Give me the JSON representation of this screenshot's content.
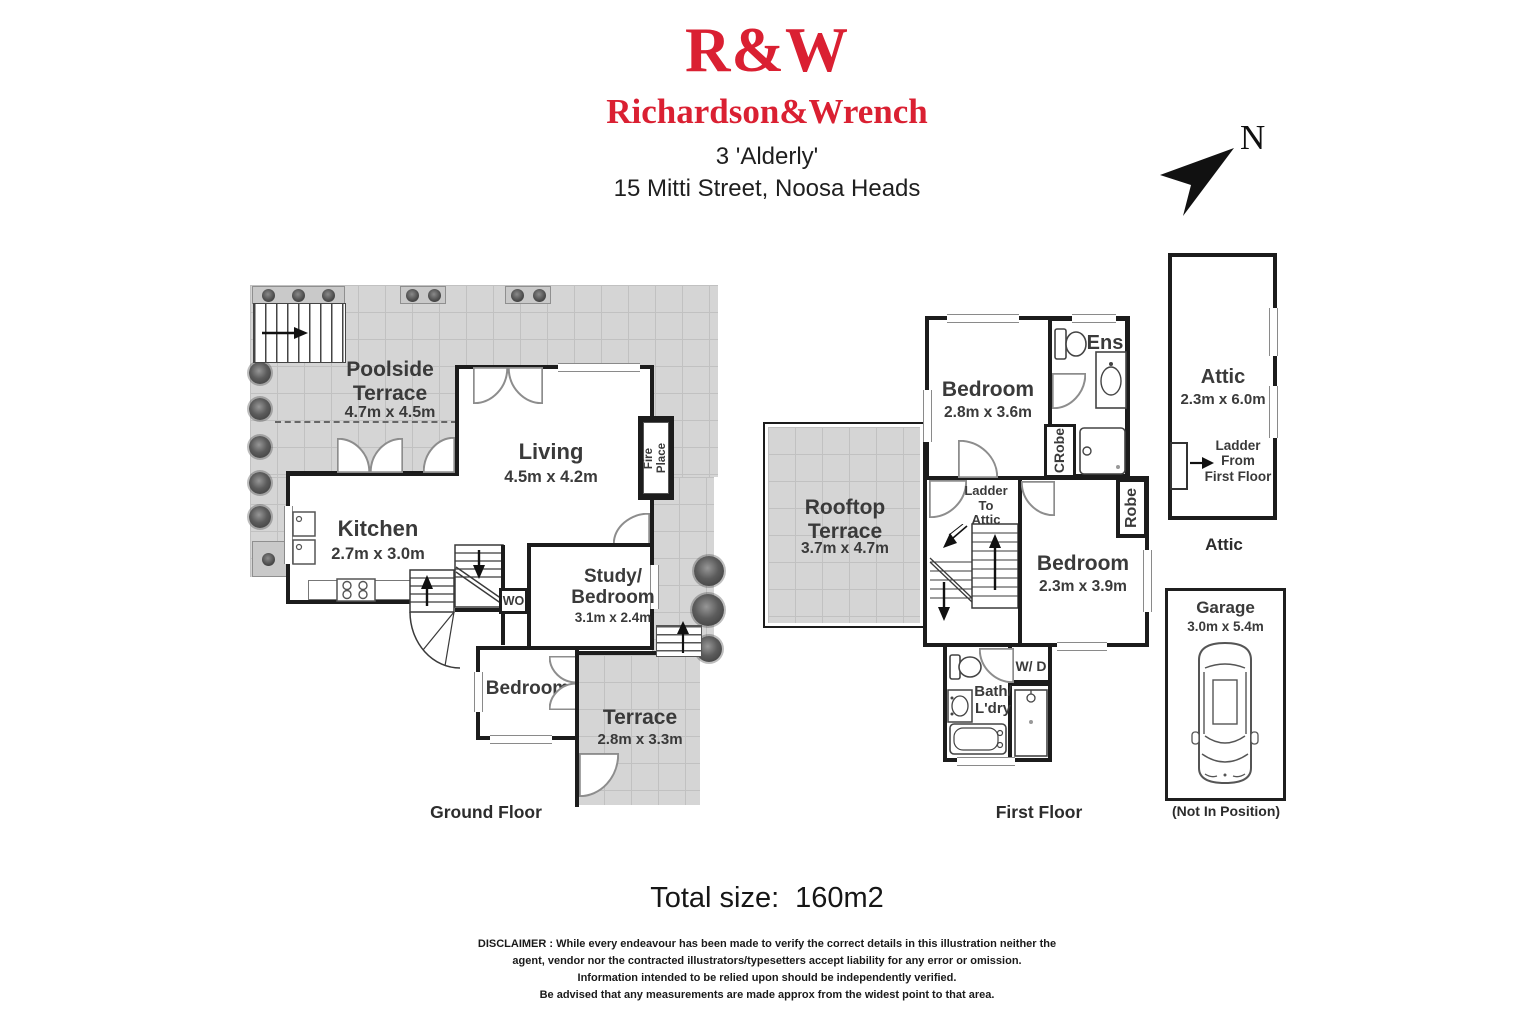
{
  "header": {
    "logo": "R&W",
    "brand": "Richardson&Wrench",
    "address_line1": "3 'Alderly'",
    "address_line2": "15 Mitti Street, Noosa Heads"
  },
  "compass": {
    "north_label": "N"
  },
  "ground_floor": {
    "floor_label": "Ground Floor",
    "poolside_terrace_name": "Poolside\nTerrace",
    "poolside_terrace_dims": "4.7m x 4.5m",
    "living_name": "Living",
    "living_dims": "4.5m x 4.2m",
    "kitchen_name": "Kitchen",
    "kitchen_dims": "2.7m x 3.0m",
    "study_name": "Study/\nBedroom",
    "study_dims": "3.1m x 2.4m",
    "bedroom_name": "Bedroom",
    "terrace_name": "Terrace",
    "terrace_dims": "2.8m x 3.3m",
    "fireplace_label": "Fire\nPlace",
    "wall_oven_label": "WO"
  },
  "first_floor": {
    "floor_label": "First Floor",
    "rooftop_terrace_name": "Rooftop\nTerrace",
    "rooftop_terrace_dims": "3.7m x 4.7m",
    "bedroom1_name": "Bedroom",
    "bedroom1_dims": "2.8m x 3.6m",
    "bedroom2_name": "Bedroom",
    "bedroom2_dims": "2.3m x 3.9m",
    "ensuite_label": "Ens",
    "robe1_label": "Robe",
    "robe1_symbol": "C",
    "robe2_label": "Robe",
    "ladder_label": "Ladder\nTo\nAttic",
    "bath_name": "Bath/\nL'dry",
    "washer_dryer_label": "W/ D"
  },
  "attic": {
    "name": "Attic",
    "dims": "2.3m x 6.0m",
    "ladder_label": "Ladder\nFrom\nFirst Floor",
    "floor_label": "Attic"
  },
  "garage": {
    "name": "Garage",
    "dims": "3.0m x 5.4m",
    "note": "(Not In Position)"
  },
  "summary": {
    "total_label": "Total size:",
    "total_value": "160m2"
  },
  "disclaimer": {
    "line1": "DISCLAIMER : While every endeavour has been made to verify the correct details in this illustration neither the",
    "line2": "agent, vendor nor the contracted illustrators/typesetters accept liability for any error or omission.",
    "line3": "Information intended to be relied upon should be independently verified.",
    "line4": "Be advised that any measurements are made approx from the widest point to that area."
  },
  "colors": {
    "brand_red": "#da2032",
    "wall": "#1c1c1c",
    "terrace_fill": "#d5d5d5"
  }
}
